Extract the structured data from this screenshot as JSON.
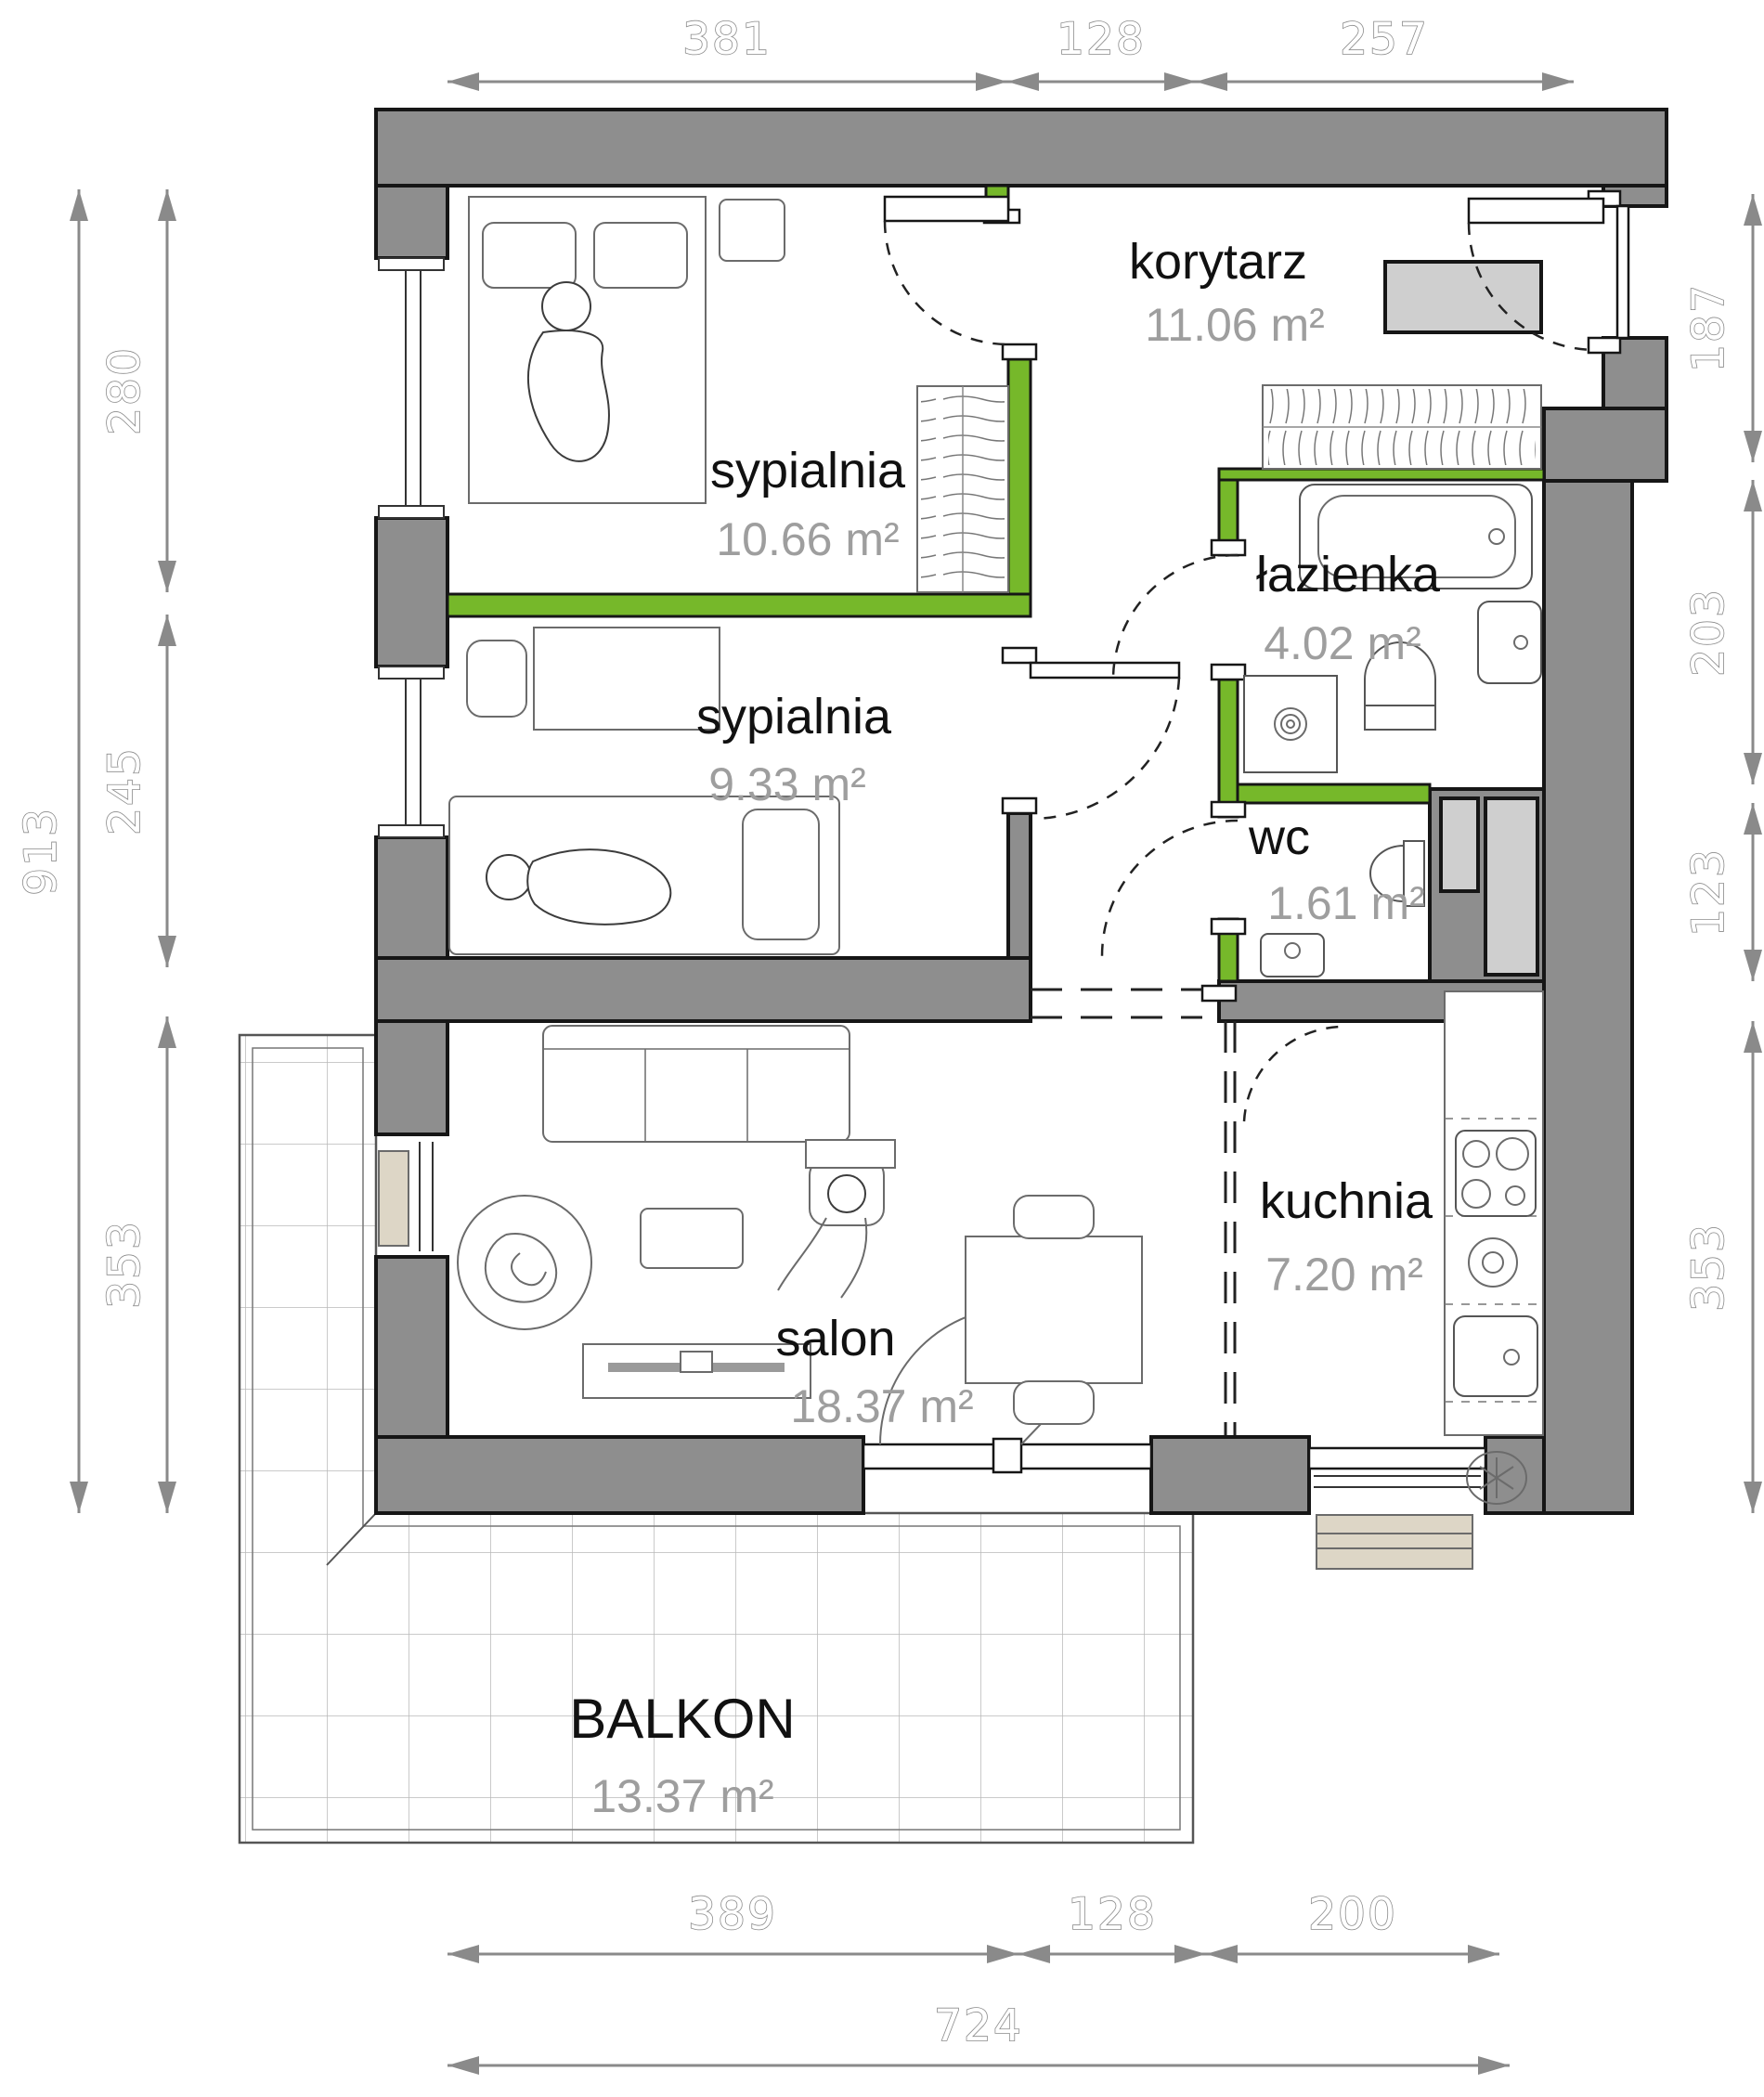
{
  "plan": {
    "type": "apartment-floor-plan",
    "rooms": [
      {
        "id": "korytarz",
        "name": "korytarz",
        "area": "11.06 m²"
      },
      {
        "id": "sypialnia1",
        "name": "sypialnia",
        "area": "10.66 m²"
      },
      {
        "id": "sypialnia2",
        "name": "sypialnia",
        "area": "9.33 m²"
      },
      {
        "id": "lazienka",
        "name": "łazienka",
        "area": "4.02 m²"
      },
      {
        "id": "wc",
        "name": "wc",
        "area": "1.61 m²"
      },
      {
        "id": "salon",
        "name": "salon",
        "area": "18.37 m²"
      },
      {
        "id": "kuchnia",
        "name": "kuchnia",
        "area": "7.20 m²"
      },
      {
        "id": "balkon",
        "name": "BALKON",
        "area": "13.37 m²"
      }
    ],
    "dimensions": {
      "top": [
        "381",
        "128",
        "257"
      ],
      "bottom": [
        "389",
        "128",
        "200"
      ],
      "bottom_total": "724",
      "left": [
        "280",
        "245",
        "353"
      ],
      "left_total": "913",
      "right": [
        "187",
        "203",
        "123",
        "353"
      ]
    },
    "colors": {
      "accent_green": "#76b82a",
      "wall_gray": "#8e8e8e",
      "shaft_gray": "#cfcfcf",
      "dimension_gray": "#8a8a8a",
      "label_black": "#111111",
      "area_gray": "#9e9e9e",
      "radiator_beige": "#ddd6c6"
    }
  }
}
